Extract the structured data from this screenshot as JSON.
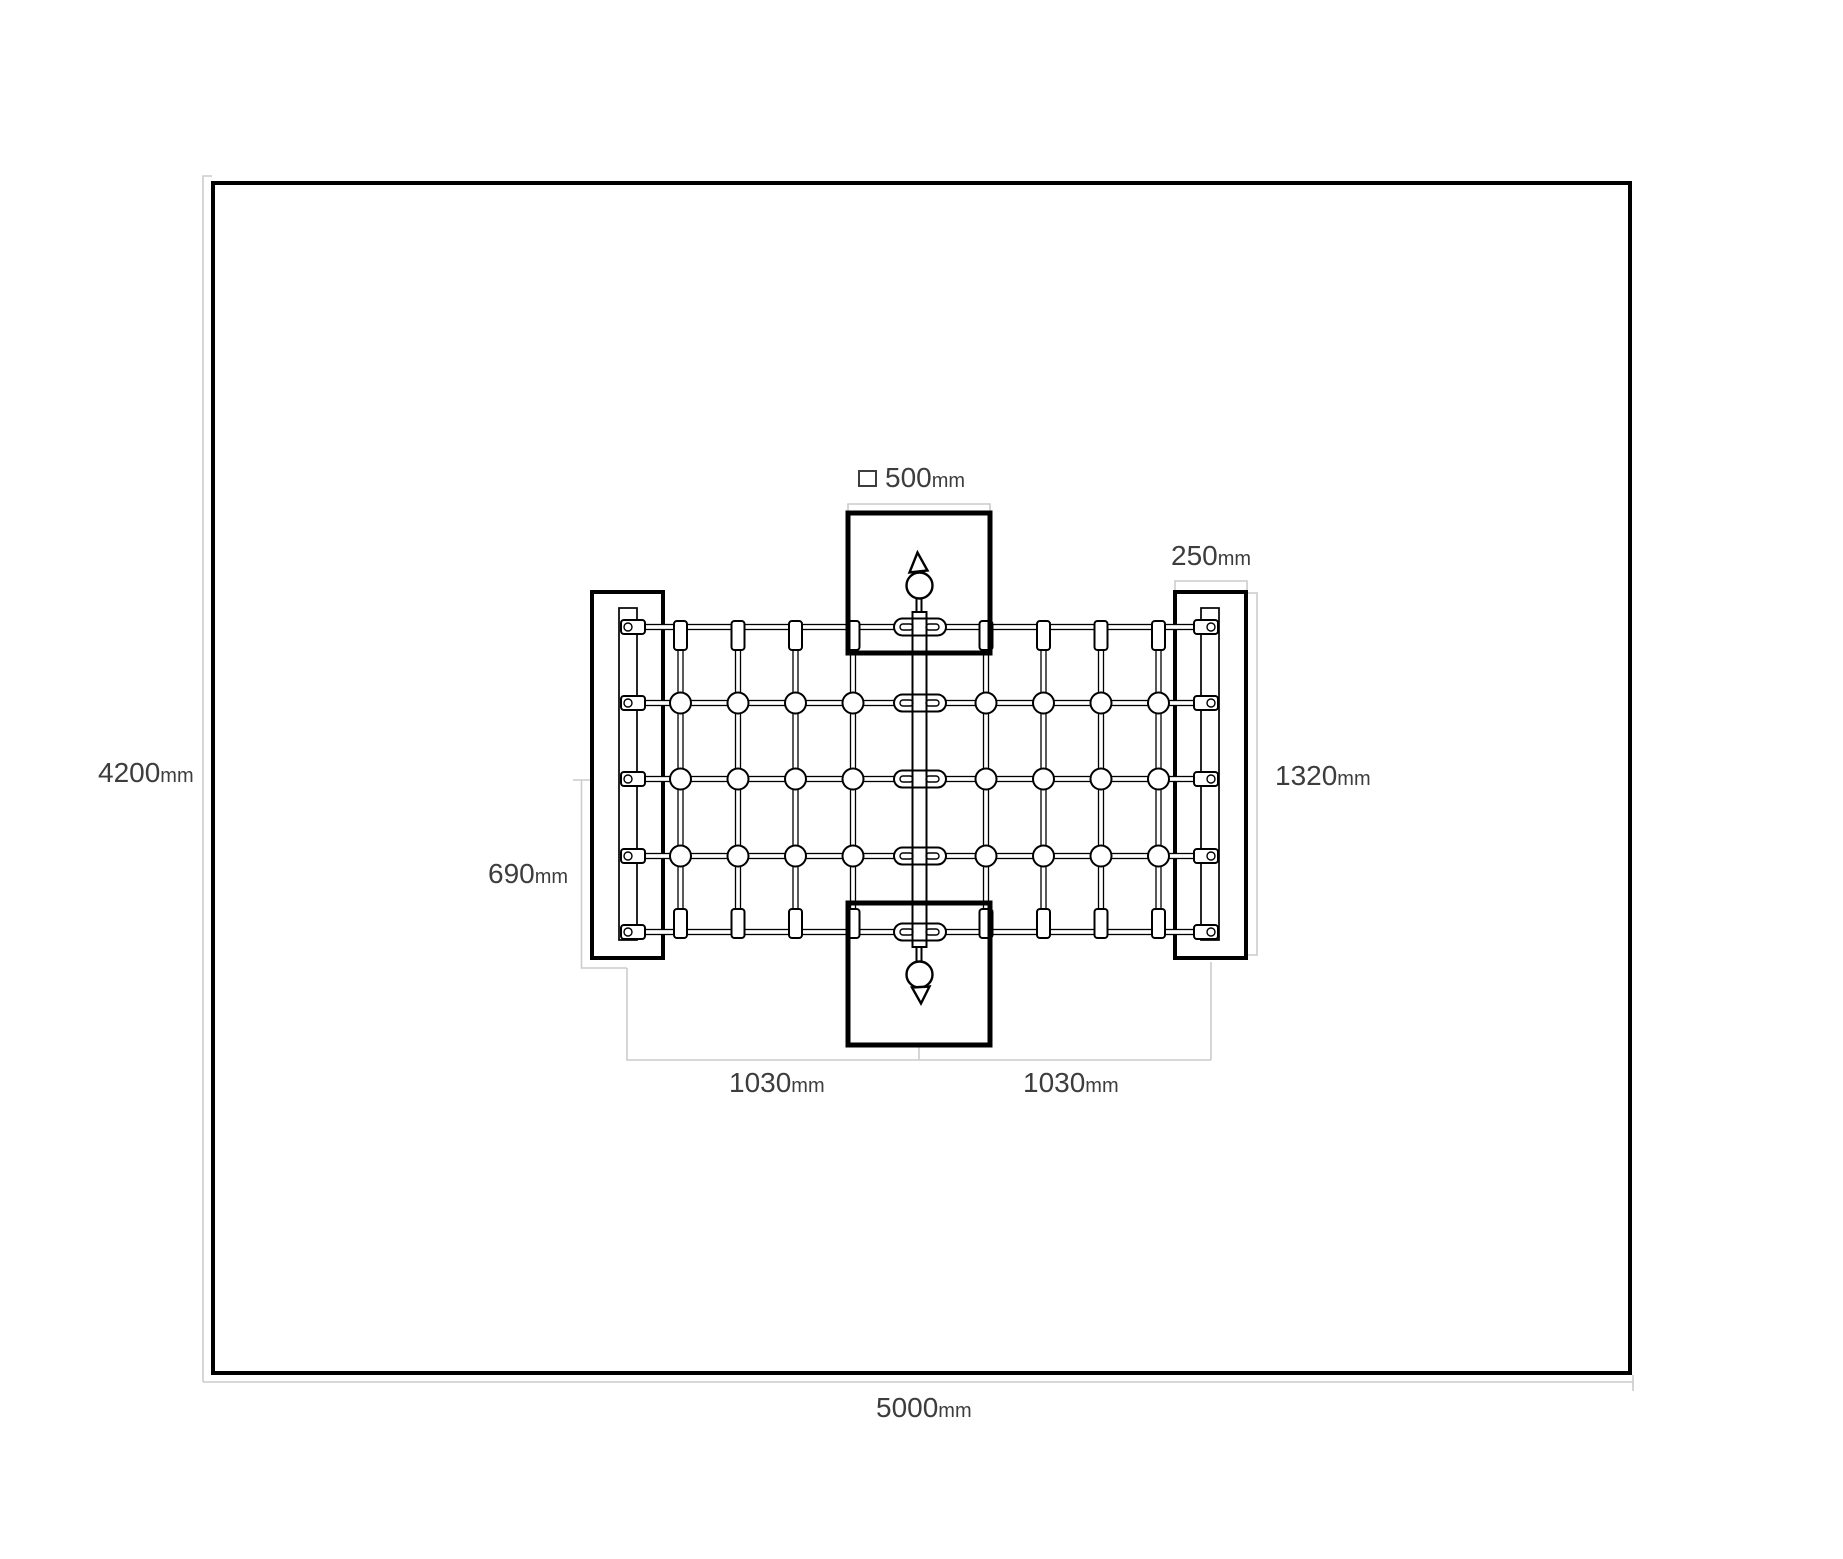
{
  "drawing_type": "playground-climbing-net-plan-view",
  "colors": {
    "background": "#ffffff",
    "outline": "#000000",
    "dimension_line": "#cccccc",
    "text": "#3d3d3d"
  },
  "dims": {
    "area_width": {
      "value": "5000",
      "unit": "mm"
    },
    "area_depth": {
      "value": "4200",
      "unit": "mm"
    },
    "top_post_section": {
      "value": "500",
      "unit": "mm",
      "icon": "square-outline"
    },
    "side_post_width": {
      "value": "250",
      "unit": "mm"
    },
    "side_post_length": {
      "value": "1320",
      "unit": "mm"
    },
    "net_offset": {
      "value": "690",
      "unit": "mm"
    },
    "half_span_left": {
      "value": "1030",
      "unit": "mm"
    },
    "half_span_right": {
      "value": "1030",
      "unit": "mm"
    }
  }
}
